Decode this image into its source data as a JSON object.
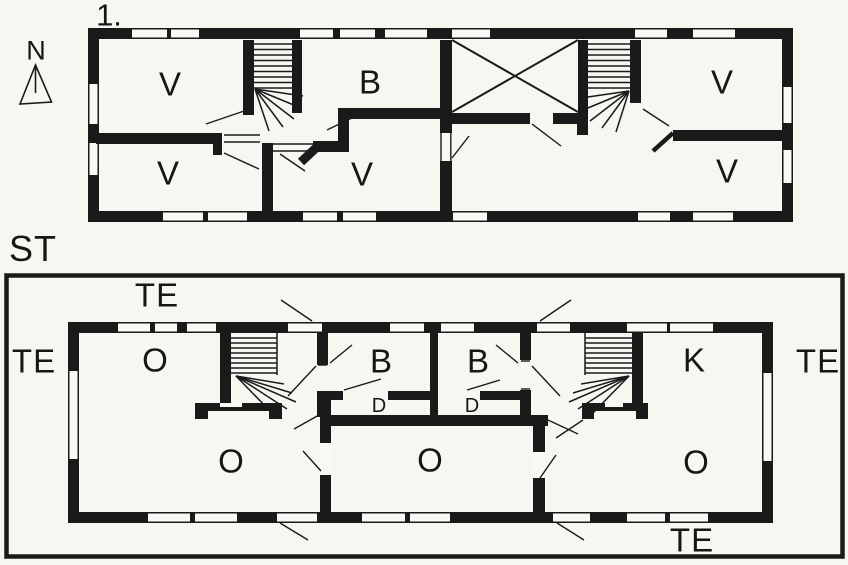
{
  "compass": {
    "label": "N"
  },
  "upper_floor": {
    "title": "1.",
    "rooms": {
      "v_top_left": "V",
      "b": "B",
      "v_top_right": "V",
      "v_bottom_left": "V",
      "v_bottom_center": "V",
      "v_bottom_right": "V"
    }
  },
  "ground_floor": {
    "title": "ST",
    "rooms": {
      "o_top_left": "O",
      "b_left": "B",
      "b_right": "B",
      "k": "K",
      "d_left": "D",
      "d_right": "D",
      "o_bottom_left": "O",
      "o_bottom_center": "O",
      "o_bottom_right": "O"
    },
    "terraces": {
      "top": "TE",
      "left": "TE",
      "right": "TE",
      "bottom": "TE"
    }
  },
  "colors": {
    "background": "#f7f6f1",
    "ink": "#1a1a1a"
  }
}
